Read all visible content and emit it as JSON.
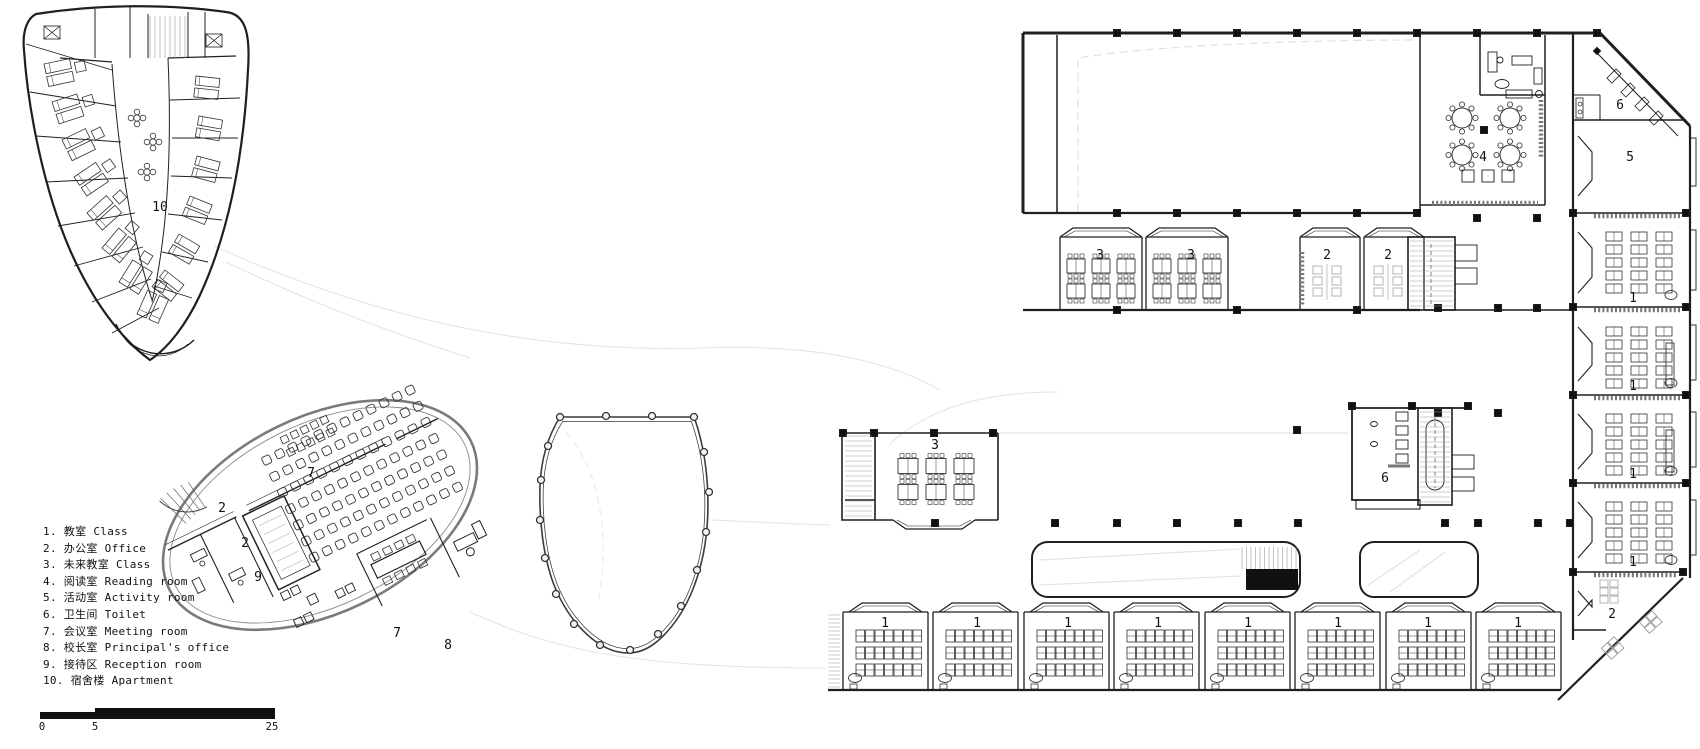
{
  "colors": {
    "ink": "#1f1f1f",
    "wall_gray": "#7a7a7a",
    "furniture_gray": "#b5b5b5",
    "faint": "#e3e3e3",
    "paper": "#ffffff"
  },
  "legend": {
    "items": [
      {
        "num": "1",
        "zh": "教室",
        "en": "Class"
      },
      {
        "num": "2",
        "zh": "办公室",
        "en": "Office"
      },
      {
        "num": "3",
        "zh": "未来教室",
        "en": "Class"
      },
      {
        "num": "4",
        "zh": "阅读室",
        "en": "Reading room"
      },
      {
        "num": "5",
        "zh": "活动室",
        "en": "Activity room"
      },
      {
        "num": "6",
        "zh": "卫生间",
        "en": "Toilet"
      },
      {
        "num": "7",
        "zh": "会议室",
        "en": "Meeting room"
      },
      {
        "num": "8",
        "zh": "校长室",
        "en": "Principal's office"
      },
      {
        "num": "9",
        "zh": "接待区",
        "en": "Reception room"
      },
      {
        "num": "10",
        "zh": "宿舍楼",
        "en": "Apartment"
      }
    ]
  },
  "scale_bar": {
    "labels": [
      "0",
      "5",
      "25"
    ]
  },
  "room_labels": [
    {
      "t": "10",
      "x": 160,
      "y": 211
    },
    {
      "t": "7",
      "x": 311,
      "y": 477
    },
    {
      "t": "2",
      "x": 222,
      "y": 512
    },
    {
      "t": "2",
      "x": 245,
      "y": 547
    },
    {
      "t": "9",
      "x": 258,
      "y": 581
    },
    {
      "t": "7",
      "x": 397,
      "y": 637
    },
    {
      "t": "8",
      "x": 448,
      "y": 649
    },
    {
      "t": "3",
      "x": 1100,
      "y": 259
    },
    {
      "t": "3",
      "x": 1191,
      "y": 259
    },
    {
      "t": "2",
      "x": 1327,
      "y": 259
    },
    {
      "t": "2",
      "x": 1388,
      "y": 259
    },
    {
      "t": "4",
      "x": 1483,
      "y": 161
    },
    {
      "t": "6",
      "x": 1620,
      "y": 109
    },
    {
      "t": "5",
      "x": 1630,
      "y": 161
    },
    {
      "t": "1",
      "x": 1633,
      "y": 302
    },
    {
      "t": "1",
      "x": 1633,
      "y": 390
    },
    {
      "t": "1",
      "x": 1633,
      "y": 478
    },
    {
      "t": "1",
      "x": 1633,
      "y": 566
    },
    {
      "t": "2",
      "x": 1612,
      "y": 618
    },
    {
      "t": "3",
      "x": 935,
      "y": 449
    },
    {
      "t": "6",
      "x": 1385,
      "y": 482
    },
    {
      "t": "1",
      "x": 885,
      "y": 627
    },
    {
      "t": "1",
      "x": 977,
      "y": 627
    },
    {
      "t": "1",
      "x": 1068,
      "y": 627
    },
    {
      "t": "1",
      "x": 1158,
      "y": 627
    },
    {
      "t": "1",
      "x": 1248,
      "y": 627
    },
    {
      "t": "1",
      "x": 1338,
      "y": 627
    },
    {
      "t": "1",
      "x": 1428,
      "y": 627
    },
    {
      "t": "1",
      "x": 1518,
      "y": 627
    }
  ]
}
